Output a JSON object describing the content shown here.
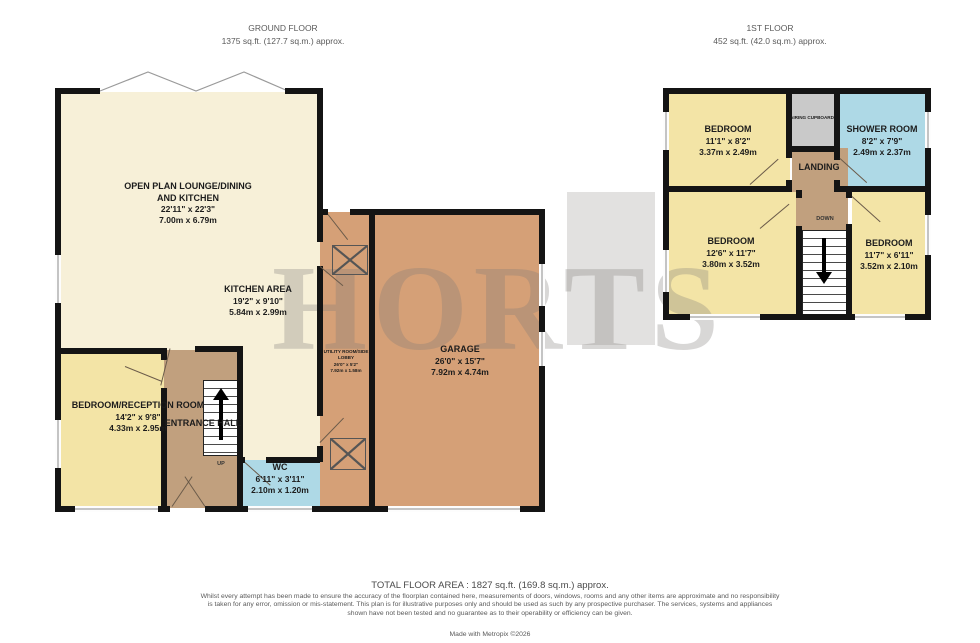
{
  "headers": {
    "ground": {
      "title": "GROUND FLOOR",
      "area": "1375 sq.ft. (127.7 sq.m.) approx."
    },
    "first": {
      "title": "1ST FLOOR",
      "area": "452 sq.ft. (42.0 sq.m.) approx."
    }
  },
  "watermark": "HORTS",
  "ground_floor": {
    "open_plan": {
      "name": "OPEN PLAN LOUNGE/DINING",
      "name2": "AND KITCHEN",
      "imperial": "22'11\" x 22'3\"",
      "metric": "7.00m x 6.79m"
    },
    "kitchen": {
      "name": "KITCHEN AREA",
      "imperial": "19'2\" x 9'10\"",
      "metric": "5.84m x 2.99m"
    },
    "garage": {
      "name": "GARAGE",
      "imperial": "26'0\" x 15'7\"",
      "metric": "7.92m x 4.74m"
    },
    "utility": {
      "name": "UTILITY ROOM/SIDE LOBBY",
      "imperial": "26'0\" x 5'2\"",
      "metric": "7.92m x 1.58m"
    },
    "bedroom_reception": {
      "name": "BEDROOM/RECEPTION ROOM",
      "imperial": "14'2\" x 9'8\"",
      "metric": "4.33m x 2.95m"
    },
    "entrance_hall": {
      "name": "ENTRANCE HALL"
    },
    "wc": {
      "name": "WC",
      "imperial": "6'11\" x 3'11\"",
      "metric": "2.10m x 1.20m"
    },
    "stairs_label": "UP"
  },
  "first_floor": {
    "bedroom_front": {
      "name": "BEDROOM",
      "imperial": "11'1\" x 8'2\"",
      "metric": "3.37m x 2.49m"
    },
    "airing_cupboard": {
      "name": "AIRING CUPBOARD"
    },
    "shower_room": {
      "name": "SHOWER ROOM",
      "imperial": "8'2\" x 7'9\"",
      "metric": "2.49m x 2.37m"
    },
    "landing": {
      "name": "LANDING"
    },
    "bedroom_left": {
      "name": "BEDROOM",
      "imperial": "12'6\" x 11'7\"",
      "metric": "3.80m x 3.52m"
    },
    "bedroom_right": {
      "name": "BEDROOM",
      "imperial": "11'7\" x 6'11\"",
      "metric": "3.52m x 2.10m"
    },
    "stairs_label": "DOWN"
  },
  "footer": {
    "total": "TOTAL FLOOR AREA : 1827 sq.ft. (169.8 sq.m.) approx.",
    "disclaimer": "Whilst every attempt has been made to ensure the accuracy of the floorplan contained here, measurements of doors, windows, rooms and any other items are approximate and no responsibility is taken for any error, omission or mis-statement. This plan is for illustrative purposes only and should be used as such by any prospective purchaser. The services, systems and appliances shown have not been tested and no guarantee as to their operability or efficiency can be given.",
    "credit": "Made with Metropix ©2026"
  },
  "colors": {
    "cream": "#f7f0d8",
    "yellow": "#f3e4a6",
    "brown": "#c1a07e",
    "tan": "#d5a077",
    "blue": "#aed9e6",
    "gray_room": "#c9c9c9",
    "wall": "#141414"
  }
}
